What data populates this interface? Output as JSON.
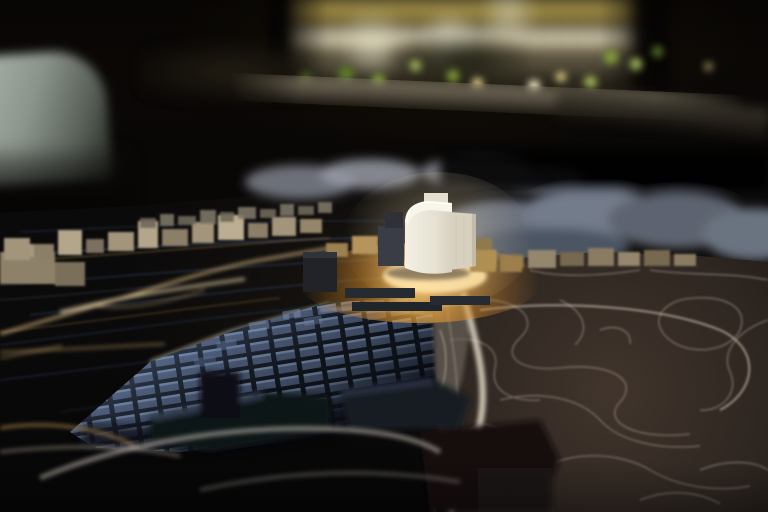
{
  "scene": {
    "type": "photograph",
    "title": "Dark exhibition room with an illuminated architectural city model; a white tower stands in focus on an amber-lit plaza",
    "regions": {
      "background_room": {
        "label": "dark exhibition room background",
        "color": "#0a0705"
      },
      "illuminated_building": {
        "label": "out-of-focus illuminated model building with glowing floor bands",
        "window_warm_color": "#f1de78",
        "window_white_color": "#fdf6dc",
        "foliage_bokeh_color": "#86a33c",
        "podium_color": "#938a76"
      },
      "chair": {
        "label": "blurred pale chair back silhouette",
        "color": "#8b948b"
      },
      "model_table": {
        "label": "projection-mapped city model tabletop",
        "color": "#0b0a0b"
      },
      "water_basin": {
        "label": "dark harbour water with projected blue current lines",
        "line_color": "#4a6ea8",
        "gold_line_color": "#b08a4a"
      },
      "shoreline_buildings": {
        "label": "beige waterfront model buildings along the quay",
        "color": "#a3957b"
      },
      "quay_lights": {
        "label": "glowing quay edge lines",
        "color": "#e3c389"
      },
      "city_grid": {
        "label": "dense grid of city blocks under blue projection",
        "block_color": "#44526b",
        "highlight_color": "#6e809c"
      },
      "tower": {
        "label": "white tower model in sharp focus",
        "face_color": "#f2efe4",
        "shade_color": "#d8d1c0",
        "rim_color": "#fffef5"
      },
      "plaza": {
        "label": "amber spotlight plaza at the tower base",
        "glow_color": "#ffbe5c"
      },
      "old_town_map": {
        "label": "dark brown map surface with white historic street network",
        "base_color": "#362c26",
        "street_color": "#b5a99b"
      },
      "highlight_road": {
        "label": "bright curving road in front of the old town",
        "color": "#e7ddcb"
      },
      "right_building_field": {
        "label": "blurred grey building field on the right horizon",
        "color": "#6b7380"
      },
      "foreground_blocks": {
        "label": "blurred dark building blocks in the near foreground",
        "color": "#15171d"
      }
    }
  }
}
